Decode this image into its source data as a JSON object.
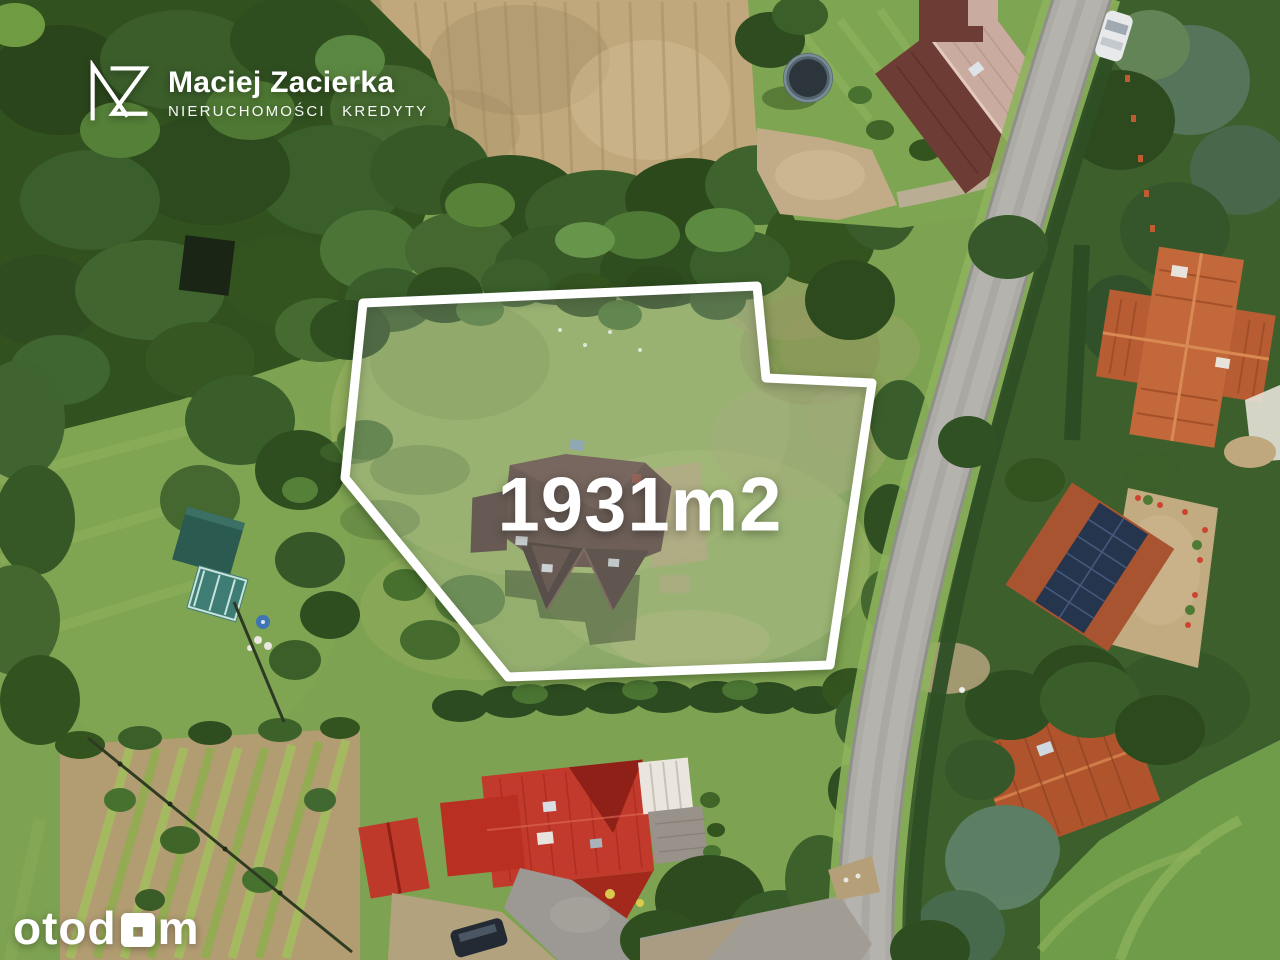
{
  "branding": {
    "monogram": "MZ",
    "name": "Maciej Zacierka",
    "tagline": "NIERUCHOMOŚCI KREDYTY"
  },
  "property": {
    "area_label": "1931m2"
  },
  "watermark": {
    "name": "otodom",
    "prefix": "otod",
    "suffix": "m"
  },
  "colors": {
    "boundary_outline": "#ffffff",
    "boundary_fill": "rgba(255,255,255,0.17)",
    "meadow_green": "#7da251",
    "forest_green": "#33511f",
    "plowed_field_tan": "#c1a87c",
    "road_gray": "#adaba5",
    "red_roof": "#c13a2b",
    "terracotta_roof": "#b85c33",
    "dark_roof": "#57433c",
    "solar_panel_blue": "#25354e"
  }
}
